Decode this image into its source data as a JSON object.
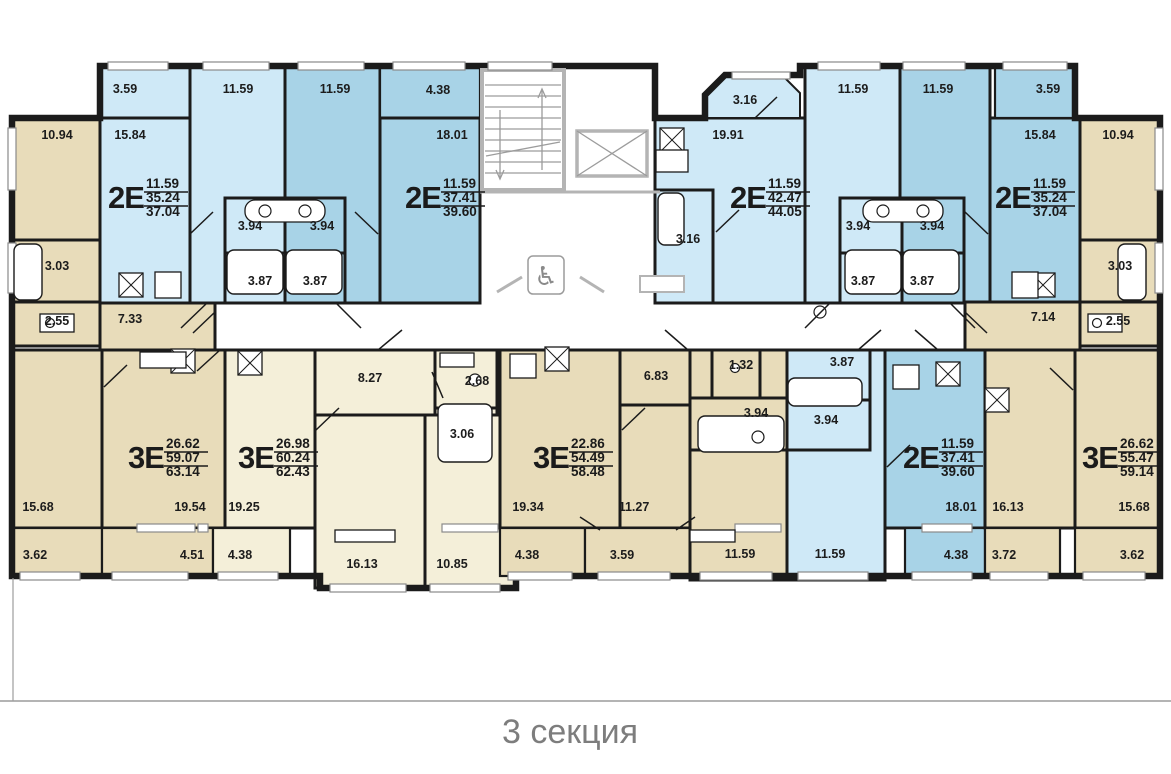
{
  "title": "3 секция",
  "colors": {
    "wall": "#1b1b1b",
    "blue_light": "#cfe9f7",
    "blue_mid": "#a8d3e7",
    "tan": "#e8dcba",
    "cream": "#f4efd9",
    "white": "#ffffff",
    "gray_wall": "#b4b4b4",
    "gray_line": "#9c9c9c",
    "window_edge": "#8a8a8a",
    "title_text": "#7d7d7d",
    "label_text": "#1c1c1c"
  },
  "apartments": [
    {
      "type": "2Е",
      "living": "11.59",
      "area": "35.24",
      "total": "37.04",
      "x": 108,
      "y": 197
    },
    {
      "type": "2Е",
      "living": "11.59",
      "area": "37.41",
      "total": "39.60",
      "x": 405,
      "y": 197
    },
    {
      "type": "2Е",
      "living": "11.59",
      "area": "42.47",
      "total": "44.05",
      "x": 730,
      "y": 197
    },
    {
      "type": "2Е",
      "living": "11.59",
      "area": "35.24",
      "total": "37.04",
      "x": 995,
      "y": 197
    },
    {
      "type": "3Е",
      "living": "26.62",
      "area": "59.07",
      "total": "63.14",
      "x": 128,
      "y": 457
    },
    {
      "type": "3Е",
      "living": "26.98",
      "area": "60.24",
      "total": "62.43",
      "x": 238,
      "y": 457
    },
    {
      "type": "3Е",
      "living": "22.86",
      "area": "54.49",
      "total": "58.48",
      "x": 533,
      "y": 457
    },
    {
      "type": "2Е",
      "living": "11.59",
      "area": "37.41",
      "total": "39.60",
      "x": 903,
      "y": 457
    },
    {
      "type": "3Е",
      "living": "26.62",
      "area": "55.47",
      "total": "59.14",
      "x": 1082,
      "y": 457
    }
  ],
  "room_labels": [
    {
      "x": 125,
      "y": 93,
      "t": "3.59"
    },
    {
      "x": 238,
      "y": 93,
      "t": "11.59"
    },
    {
      "x": 335,
      "y": 93,
      "t": "11.59"
    },
    {
      "x": 438,
      "y": 94,
      "t": "4.38"
    },
    {
      "x": 745,
      "y": 104,
      "t": "3.16"
    },
    {
      "x": 853,
      "y": 93,
      "t": "11.59"
    },
    {
      "x": 938,
      "y": 93,
      "t": "11.59"
    },
    {
      "x": 1048,
      "y": 93,
      "t": "3.59"
    },
    {
      "x": 57,
      "y": 139,
      "t": "10.94"
    },
    {
      "x": 130,
      "y": 139,
      "t": "15.84"
    },
    {
      "x": 452,
      "y": 139,
      "t": "18.01"
    },
    {
      "x": 728,
      "y": 139,
      "t": "19.91"
    },
    {
      "x": 1040,
      "y": 139,
      "t": "15.84"
    },
    {
      "x": 1118,
      "y": 139,
      "t": "10.94"
    },
    {
      "x": 250,
      "y": 230,
      "t": "3.94"
    },
    {
      "x": 322,
      "y": 230,
      "t": "3.94"
    },
    {
      "x": 688,
      "y": 243,
      "t": "3.16"
    },
    {
      "x": 858,
      "y": 230,
      "t": "3.94"
    },
    {
      "x": 932,
      "y": 230,
      "t": "3.94"
    },
    {
      "x": 57,
      "y": 270,
      "t": "3.03"
    },
    {
      "x": 1120,
      "y": 270,
      "t": "3.03"
    },
    {
      "x": 260,
      "y": 285,
      "t": "3.87"
    },
    {
      "x": 315,
      "y": 285,
      "t": "3.87"
    },
    {
      "x": 863,
      "y": 285,
      "t": "3.87"
    },
    {
      "x": 922,
      "y": 285,
      "t": "3.87"
    },
    {
      "x": 57,
      "y": 325,
      "t": "2.55"
    },
    {
      "x": 130,
      "y": 323,
      "t": "7.33"
    },
    {
      "x": 1043,
      "y": 321,
      "t": "7.14"
    },
    {
      "x": 1118,
      "y": 325,
      "t": "2.55"
    },
    {
      "x": 370,
      "y": 382,
      "t": "8.27"
    },
    {
      "x": 477,
      "y": 385,
      "t": "2.68"
    },
    {
      "x": 656,
      "y": 380,
      "t": "6.83"
    },
    {
      "x": 741,
      "y": 369,
      "t": "1.32"
    },
    {
      "x": 842,
      "y": 366,
      "t": "3.87"
    },
    {
      "x": 462,
      "y": 438,
      "t": "3.06"
    },
    {
      "x": 756,
      "y": 417,
      "t": "3.94"
    },
    {
      "x": 826,
      "y": 424,
      "t": "3.94"
    },
    {
      "x": 38,
      "y": 511,
      "t": "15.68"
    },
    {
      "x": 190,
      "y": 511,
      "t": "19.54"
    },
    {
      "x": 244,
      "y": 511,
      "t": "19.25"
    },
    {
      "x": 528,
      "y": 511,
      "t": "19.34"
    },
    {
      "x": 634,
      "y": 511,
      "t": "11.27"
    },
    {
      "x": 961,
      "y": 511,
      "t": "18.01"
    },
    {
      "x": 1008,
      "y": 511,
      "t": "16.13"
    },
    {
      "x": 1134,
      "y": 511,
      "t": "15.68"
    },
    {
      "x": 35,
      "y": 559,
      "t": "3.62"
    },
    {
      "x": 192,
      "y": 559,
      "t": "4.51"
    },
    {
      "x": 240,
      "y": 559,
      "t": "4.38"
    },
    {
      "x": 362,
      "y": 568,
      "t": "16.13"
    },
    {
      "x": 452,
      "y": 568,
      "t": "10.85"
    },
    {
      "x": 527,
      "y": 559,
      "t": "4.38"
    },
    {
      "x": 622,
      "y": 559,
      "t": "3.59"
    },
    {
      "x": 740,
      "y": 558,
      "t": "11.59"
    },
    {
      "x": 830,
      "y": 558,
      "t": "11.59"
    },
    {
      "x": 956,
      "y": 559,
      "t": "4.38"
    },
    {
      "x": 1004,
      "y": 559,
      "t": "3.72"
    },
    {
      "x": 1132,
      "y": 559,
      "t": "3.62"
    }
  ],
  "rooms": [
    [
      "w",
      480,
      66,
      175,
      284,
      0
    ],
    [
      "w",
      215,
      303,
      770,
      47,
      0
    ],
    [
      "t",
      12,
      118,
      88,
      122
    ],
    [
      "t",
      12,
      240,
      88,
      62
    ],
    [
      "t",
      12,
      302,
      88,
      44
    ],
    [
      "t",
      100,
      302,
      115,
      48
    ],
    [
      "b1",
      100,
      66,
      90,
      52,
      2.2
    ],
    [
      "b1",
      100,
      118,
      90,
      185
    ],
    [
      "b1",
      190,
      66,
      95,
      237
    ],
    [
      "b2",
      285,
      66,
      95,
      237
    ],
    [
      "b2",
      380,
      66,
      100,
      52,
      2.2
    ],
    [
      "b2",
      380,
      118,
      100,
      185
    ],
    [
      "b1",
      225,
      198,
      60,
      55
    ],
    [
      "b1",
      225,
      253,
      60,
      50
    ],
    [
      "b2",
      285,
      198,
      60,
      55
    ],
    [
      "b2",
      285,
      253,
      60,
      50
    ],
    [
      "b1",
      655,
      118,
      150,
      185
    ],
    [
      "b1",
      655,
      190,
      58,
      113
    ],
    [
      "b1",
      805,
      66,
      95,
      237
    ],
    [
      "b2",
      900,
      66,
      90,
      237
    ],
    [
      "b2",
      990,
      118,
      90,
      185
    ],
    [
      "b2",
      995,
      66,
      80,
      52,
      2.2
    ],
    [
      "b1",
      840,
      198,
      62,
      55
    ],
    [
      "b1",
      840,
      253,
      62,
      50
    ],
    [
      "b2",
      902,
      198,
      62,
      55
    ],
    [
      "b2",
      902,
      253,
      62,
      50
    ],
    [
      "t",
      1080,
      118,
      80,
      122
    ],
    [
      "t",
      1080,
      240,
      80,
      62
    ],
    [
      "t",
      1080,
      302,
      80,
      44
    ],
    [
      "t",
      965,
      302,
      115,
      48
    ],
    [
      "t",
      12,
      350,
      90,
      178
    ],
    [
      "t",
      102,
      350,
      123,
      178
    ],
    [
      "t",
      12,
      528,
      90,
      48,
      2.2
    ],
    [
      "t",
      102,
      528,
      111,
      48,
      2.2
    ],
    [
      "c",
      225,
      350,
      90,
      178
    ],
    [
      "c",
      213,
      528,
      77,
      48,
      2.2
    ],
    [
      "c",
      315,
      350,
      120,
      65
    ],
    [
      "c",
      435,
      350,
      62,
      58
    ],
    [
      "c",
      435,
      408,
      62,
      62
    ],
    [
      "c",
      315,
      415,
      110,
      173
    ],
    [
      "c",
      425,
      415,
      90,
      173
    ],
    [
      "t",
      500,
      350,
      120,
      178
    ],
    [
      "t",
      500,
      528,
      85,
      48,
      2.2
    ],
    [
      "t",
      620,
      350,
      80,
      55
    ],
    [
      "t",
      620,
      405,
      80,
      123
    ],
    [
      "t",
      585,
      528,
      105,
      48,
      2.2
    ],
    [
      "t",
      690,
      350,
      97,
      230
    ],
    [
      "t",
      712,
      350,
      48,
      48
    ],
    [
      "t",
      690,
      398,
      97,
      52
    ],
    [
      "b1",
      787,
      350,
      98,
      230
    ],
    [
      "b1",
      787,
      350,
      83,
      50
    ],
    [
      "b1",
      787,
      400,
      83,
      50
    ],
    [
      "b2",
      885,
      350,
      100,
      178
    ],
    [
      "b2",
      905,
      528,
      80,
      48,
      2.2
    ],
    [
      "t",
      985,
      350,
      90,
      178
    ],
    [
      "t",
      985,
      528,
      75,
      48,
      2.2
    ],
    [
      "t",
      1075,
      350,
      85,
      178
    ],
    [
      "t",
      1075,
      528,
      85,
      48,
      2.2
    ]
  ],
  "outline_path": "M12,345 L12,118 L100,118 L100,66 L655,66 L655,118 L705,118 L705,95 L725,75 L800,75 L800,66 L1075,66 L1075,118 L1160,118 L1160,576 L516,576 L516,588 L320,588 L320,576 L12,576 Z",
  "chamfer_balcony": {
    "points": "705,118 705,95 722,76 783,76 800,93 800,118",
    "fill": "b1"
  },
  "windows": [
    [
      108,
      62,
      60,
      8
    ],
    [
      203,
      62,
      66,
      8
    ],
    [
      298,
      62,
      66,
      8
    ],
    [
      393,
      62,
      72,
      8
    ],
    [
      488,
      62,
      64,
      8
    ],
    [
      818,
      62,
      62,
      8
    ],
    [
      903,
      62,
      62,
      8
    ],
    [
      1003,
      62,
      64,
      8
    ],
    [
      732,
      72,
      58,
      7
    ],
    [
      8,
      128,
      8,
      62
    ],
    [
      8,
      243,
      8,
      50
    ],
    [
      1155,
      128,
      8,
      62
    ],
    [
      1155,
      243,
      8,
      50
    ],
    [
      20,
      572,
      60,
      8
    ],
    [
      112,
      572,
      76,
      8
    ],
    [
      218,
      572,
      60,
      8
    ],
    [
      508,
      572,
      64,
      8
    ],
    [
      598,
      572,
      72,
      8
    ],
    [
      700,
      572,
      72,
      8
    ],
    [
      798,
      572,
      70,
      8
    ],
    [
      912,
      572,
      60,
      8
    ],
    [
      990,
      572,
      58,
      8
    ],
    [
      1083,
      572,
      62,
      8
    ],
    [
      330,
      584,
      76,
      8
    ],
    [
      430,
      584,
      70,
      8
    ],
    [
      137,
      524,
      58,
      8
    ],
    [
      442,
      524,
      56,
      8
    ],
    [
      735,
      524,
      46,
      8
    ],
    [
      922,
      524,
      50,
      8
    ],
    [
      198,
      524,
      10,
      8
    ]
  ],
  "doors": [
    [
      207,
      303,
      181,
      328
    ],
    [
      336,
      303,
      361,
      328
    ],
    [
      830,
      303,
      805,
      328
    ],
    [
      950,
      303,
      975,
      328
    ],
    [
      215,
      312,
      193,
      333
    ],
    [
      965,
      312,
      987,
      333
    ],
    [
      220,
      350,
      197,
      371
    ],
    [
      378,
      350,
      402,
      330
    ],
    [
      688,
      350,
      665,
      330
    ],
    [
      858,
      350,
      881,
      330
    ],
    [
      938,
      350,
      915,
      330
    ],
    [
      190,
      234,
      213,
      212
    ],
    [
      378,
      234,
      355,
      212
    ],
    [
      716,
      232,
      739,
      210
    ],
    [
      988,
      234,
      965,
      212
    ],
    [
      104,
      387,
      127,
      365
    ],
    [
      316,
      430,
      339,
      408
    ],
    [
      622,
      430,
      645,
      408
    ],
    [
      887,
      467,
      910,
      445
    ],
    [
      1073,
      390,
      1050,
      368
    ],
    [
      755,
      118,
      777,
      97
    ],
    [
      432,
      372,
      443,
      398
    ],
    [
      580,
      517,
      600,
      530
    ],
    [
      695,
      517,
      676,
      530
    ]
  ],
  "crossboxes": [
    [
      131,
      285
    ],
    [
      1043,
      285
    ],
    [
      672,
      140
    ],
    [
      183,
      361
    ],
    [
      250,
      363
    ],
    [
      557,
      359
    ],
    [
      948,
      374
    ],
    [
      997,
      400
    ]
  ],
  "tubs": [
    [
      227,
      250,
      56,
      44
    ],
    [
      286,
      250,
      56,
      44
    ],
    [
      845,
      250,
      56,
      44
    ],
    [
      903,
      250,
      56,
      44
    ],
    [
      698,
      416,
      86,
      36
    ],
    [
      788,
      378,
      74,
      28
    ],
    [
      438,
      404,
      54,
      58
    ],
    [
      14,
      244,
      28,
      56
    ],
    [
      1118,
      244,
      28,
      56
    ],
    [
      658,
      193,
      26,
      52
    ]
  ],
  "boxes": [
    [
      155,
      272,
      26,
      26
    ],
    [
      1012,
      272,
      26,
      26
    ],
    [
      140,
      352,
      46,
      16
    ],
    [
      510,
      354,
      26,
      24
    ],
    [
      893,
      365,
      26,
      24
    ],
    [
      656,
      150,
      32,
      22
    ],
    [
      40,
      314,
      34,
      18
    ],
    [
      1088,
      314,
      34,
      18
    ],
    [
      440,
      353,
      34,
      14
    ],
    [
      335,
      530,
      60,
      12
    ],
    [
      690,
      530,
      45,
      12
    ]
  ],
  "sink_rects": [
    [
      245,
      200,
      80,
      22
    ],
    [
      863,
      200,
      80,
      22
    ]
  ],
  "sink_circles": [
    [
      265,
      211
    ],
    [
      305,
      211
    ],
    [
      883,
      211
    ],
    [
      923,
      211
    ],
    [
      475,
      380
    ],
    [
      758,
      437
    ],
    [
      820,
      312
    ]
  ],
  "toilet_circles": [
    [
      50,
      323
    ],
    [
      1097,
      323
    ],
    [
      735,
      368
    ]
  ],
  "stairs": {
    "x": 482,
    "y": 70,
    "w": 82,
    "h": 120,
    "steps": 10
  },
  "elevator": {
    "x": 577,
    "y": 131,
    "w": 70,
    "h": 45
  },
  "wheelchair": {
    "box": [
      528,
      256,
      36,
      38
    ],
    "glyph": "♿",
    "tx": 546,
    "ty": 285
  },
  "gray_lines": [
    [
      480,
      192,
      660,
      192
    ],
    [
      497,
      292,
      522,
      277
    ],
    [
      604,
      292,
      580,
      277
    ]
  ],
  "gray_box": [
    640,
    276,
    44,
    16
  ],
  "baseline": {
    "y": 701,
    "tick_x": 13,
    "tick_y1": 578,
    "tick_y2": 701
  },
  "title_pos": {
    "x": 570,
    "y": 743
  }
}
